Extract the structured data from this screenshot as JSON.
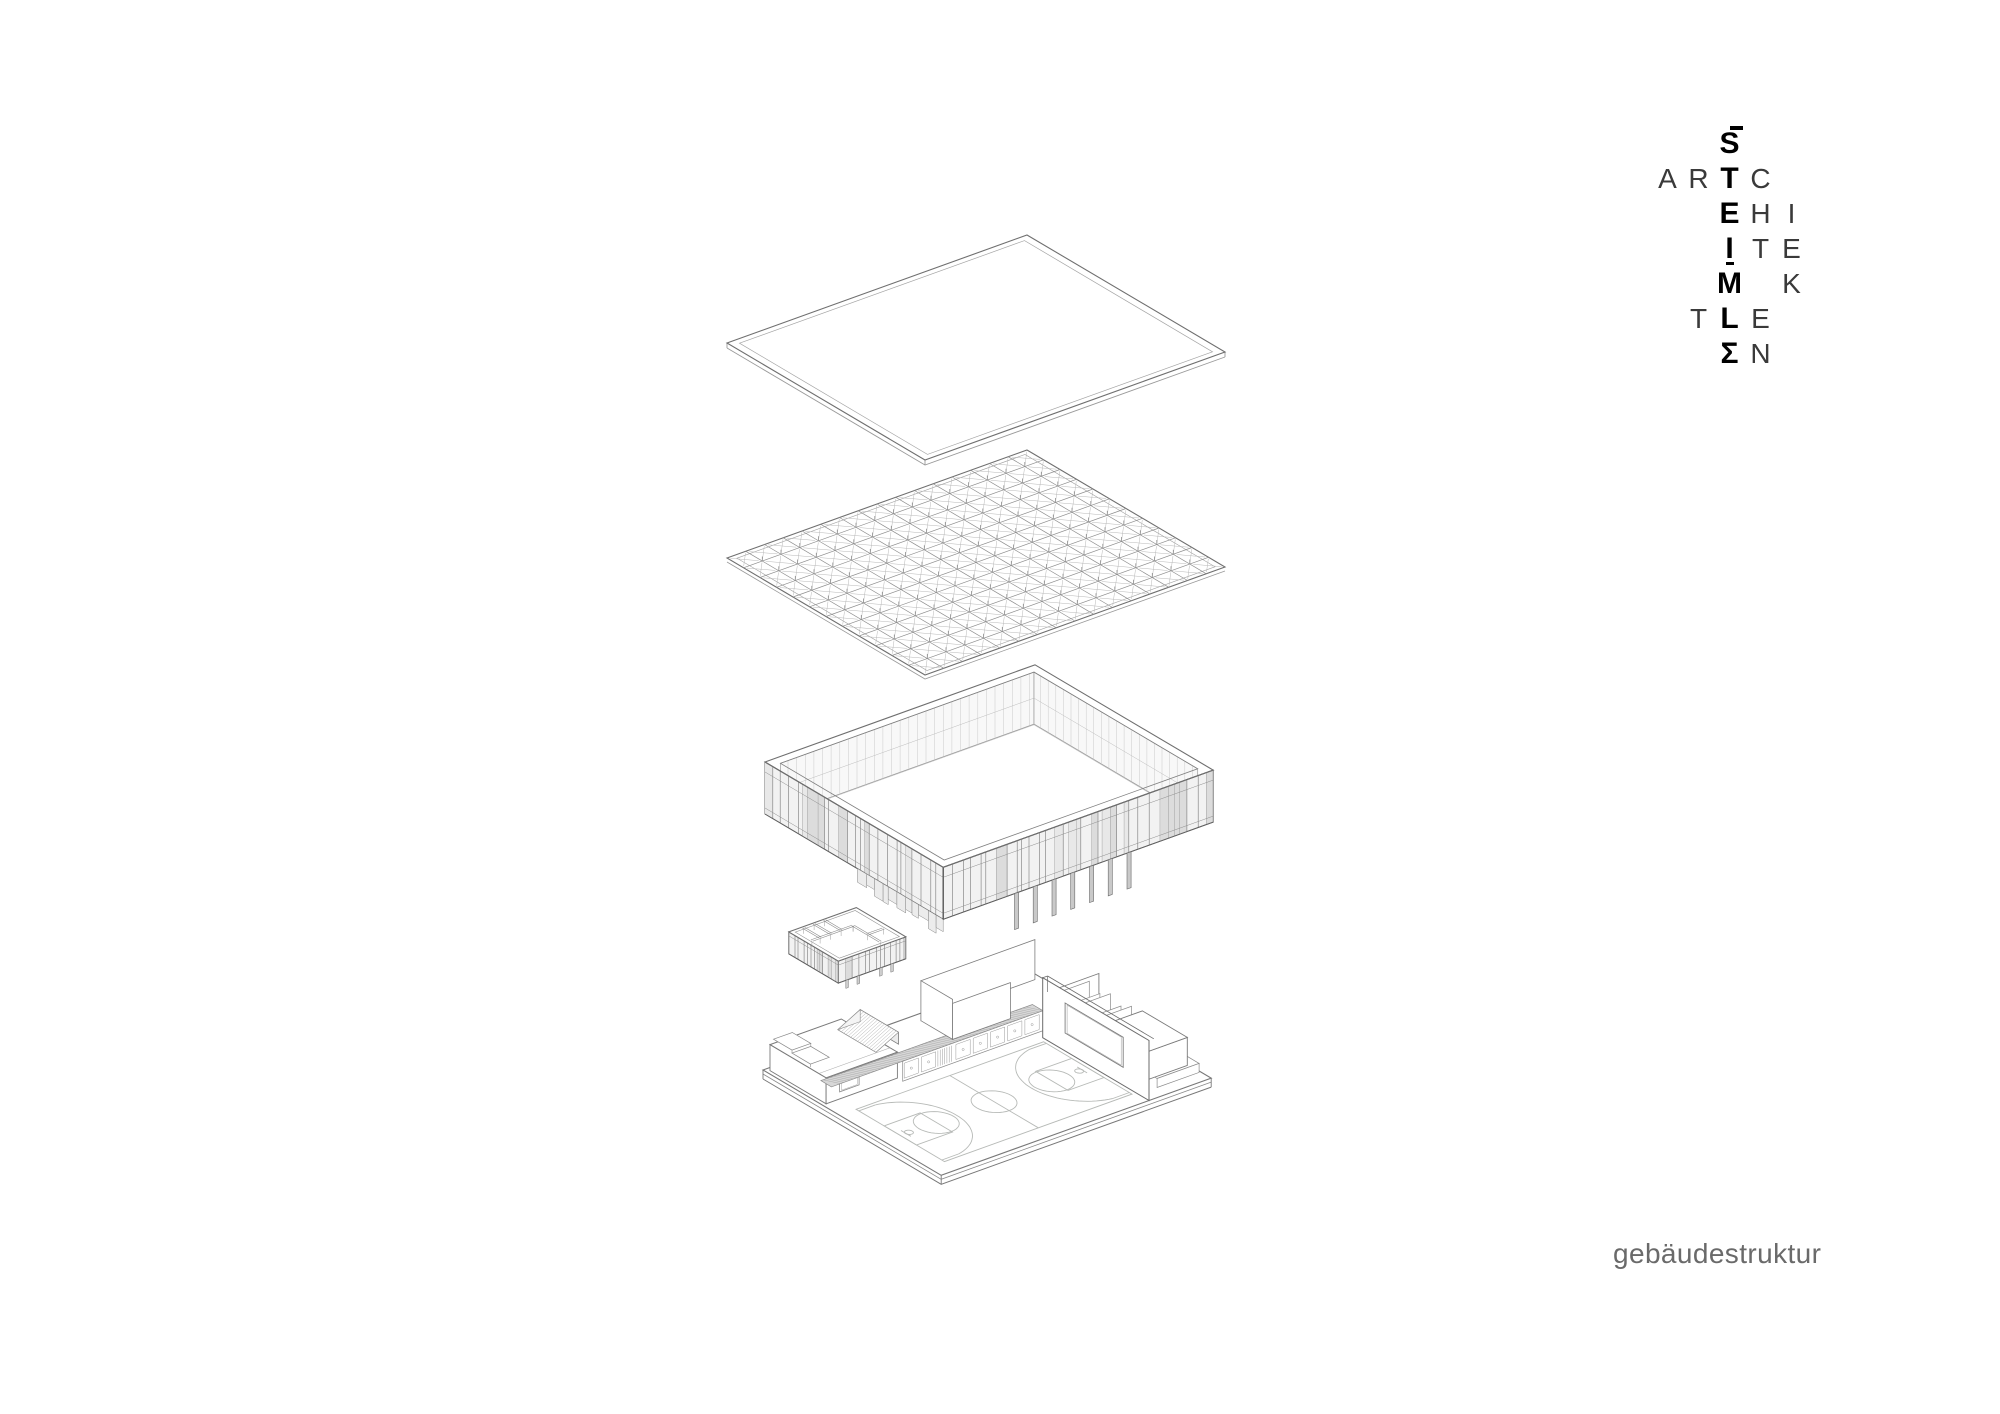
{
  "page": {
    "background": "#ffffff"
  },
  "logo": {
    "brand_vertical": "STEIMLE",
    "brand_horizontal": "ARCHITEKTEN",
    "cells": [
      {
        "r": 0,
        "c": 2,
        "ch": "S",
        "bold": true,
        "bar": true
      },
      {
        "r": 1,
        "c": 0,
        "ch": "A"
      },
      {
        "r": 1,
        "c": 1,
        "ch": "R"
      },
      {
        "r": 1,
        "c": 2,
        "ch": "T",
        "bold": true
      },
      {
        "r": 1,
        "c": 3,
        "ch": "C"
      },
      {
        "r": 2,
        "c": 2,
        "ch": "E",
        "bold": true
      },
      {
        "r": 2,
        "c": 3,
        "ch": "H"
      },
      {
        "r": 2,
        "c": 4,
        "ch": "I"
      },
      {
        "r": 3,
        "c": 2,
        "ch": "I",
        "bold": true,
        "dot": true
      },
      {
        "r": 3,
        "c": 3,
        "ch": "T"
      },
      {
        "r": 3,
        "c": 4,
        "ch": "E"
      },
      {
        "r": 4,
        "c": 2,
        "ch": "M",
        "bold": true
      },
      {
        "r": 4,
        "c": 4,
        "ch": "K"
      },
      {
        "r": 5,
        "c": 1,
        "ch": "T"
      },
      {
        "r": 5,
        "c": 2,
        "ch": "L",
        "bold": true
      },
      {
        "r": 5,
        "c": 3,
        "ch": "E"
      },
      {
        "r": 6,
        "c": 2,
        "ch": "Σ",
        "bold": true
      },
      {
        "r": 6,
        "c": 3,
        "ch": "N"
      }
    ]
  },
  "caption": {
    "text": "gebäudestruktur"
  },
  "colors": {
    "ink": "#000000",
    "light_letter": "#3a3a3a",
    "caption": "#6a6a6a",
    "line": "#8a8a8a",
    "line_dark": "#5f5f5f",
    "louver_fill": "#f2f2f2",
    "louver_dark": "#dcdcdc",
    "hatch": "#a0a0a0",
    "court_line": "#b7bab7"
  },
  "diagram": {
    "projection": {
      "a": [
        7.5,
        -2.7
      ],
      "b": [
        6.6,
        3.9
      ]
    },
    "layers": {
      "roof": {
        "origin": [
          727,
          343
        ],
        "A": 40,
        "B": 30
      },
      "grid": {
        "origin": [
          727,
          558
        ],
        "A": 40,
        "B": 30,
        "cols": 16,
        "rows": 12
      },
      "facade": {
        "origin": [
          765,
          762
        ],
        "A": 36,
        "B": 27,
        "wall_h": 52
      },
      "annex": {
        "origin": [
          763,
          938
        ],
        "a0": 3,
        "a1": 12,
        "b0": 0.5,
        "b1": 8,
        "wall_h": 22
      },
      "ground": {
        "origin": [
          763,
          1070
        ],
        "A": 36,
        "B": 27,
        "slab_t": 9
      }
    }
  }
}
